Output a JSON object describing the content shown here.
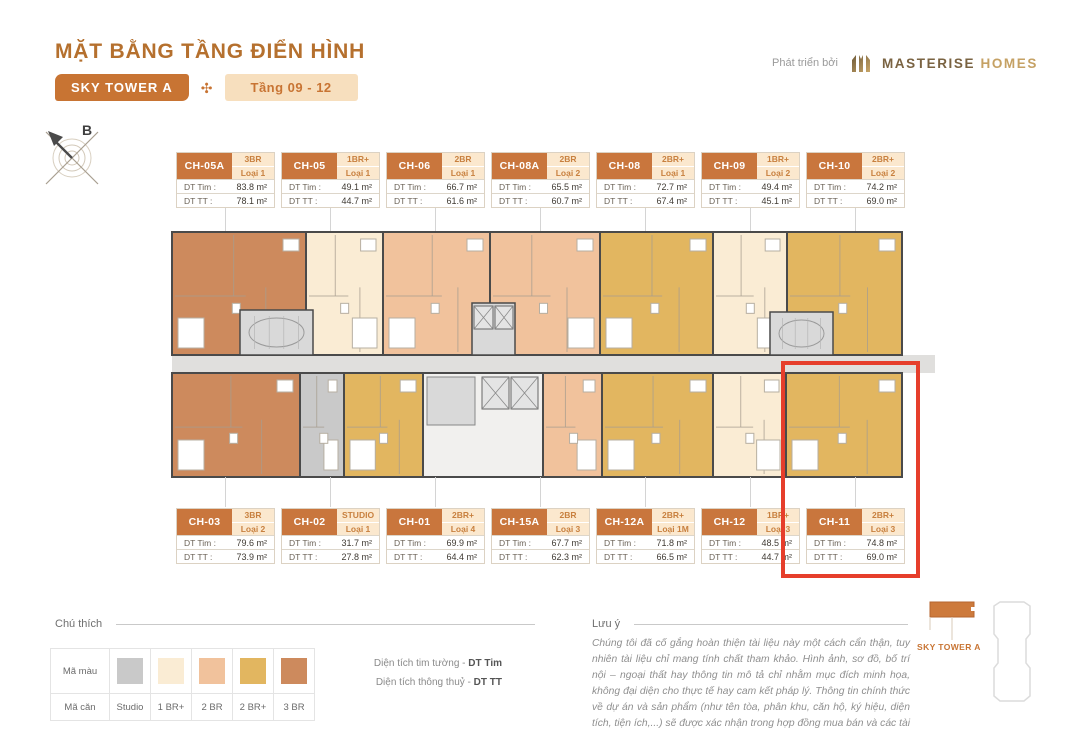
{
  "header": {
    "title": "MẶT BẰNG TẦNG ĐIỂN HÌNH",
    "tower_badge": "SKY TOWER A",
    "ornament_icon": "✣",
    "floor_badge": "Tầng 09 - 12",
    "developer_label": "Phát triển bởi",
    "developer_name_1": "MASTERISE",
    "developer_name_2": "HOMES"
  },
  "compass": {
    "label": "B"
  },
  "labels": {
    "dt_tim": "DT Tim :",
    "dt_tt": "DT TT :"
  },
  "colors": {
    "accent": "#c87433",
    "wall": "#4a4a4a",
    "corridor": "#e0dfdd",
    "core": "#d9d9d9",
    "highlight": "#e63e2b",
    "studio": "#c9c9c9",
    "br1p": "#faecd4",
    "br2": "#f1c29c",
    "br2p": "#e2b660",
    "br3": "#cd8a5d"
  },
  "plan": {
    "top_band": {
      "y": 232,
      "h": 123
    },
    "bottom_band": {
      "y": 373,
      "h": 104
    },
    "corridor": {
      "x": 172,
      "y": 355,
      "w": 763,
      "h": 18
    }
  },
  "units": {
    "top": [
      {
        "name": "CH-05A",
        "type": "3BR",
        "loai": "Loại 1",
        "tim": "83.8 m²",
        "tt": "78.1 m²",
        "color": "br3",
        "px": 172,
        "pw": 134,
        "highlighted": false
      },
      {
        "name": "CH-05",
        "type": "1BR+",
        "loai": "Loại 1",
        "tim": "49.1 m²",
        "tt": "44.7 m²",
        "color": "br1p",
        "px": 306,
        "pw": 77,
        "highlighted": false
      },
      {
        "name": "CH-06",
        "type": "2BR",
        "loai": "Loại 1",
        "tim": "66.7 m²",
        "tt": "61.6 m²",
        "color": "br2",
        "px": 383,
        "pw": 107,
        "highlighted": false
      },
      {
        "name": "CH-08A",
        "type": "2BR",
        "loai": "Loại 2",
        "tim": "65.5 m²",
        "tt": "60.7 m²",
        "color": "br2",
        "px": 490,
        "pw": 110,
        "highlighted": false
      },
      {
        "name": "CH-08",
        "type": "2BR+",
        "loai": "Loại 1",
        "tim": "72.7 m²",
        "tt": "67.4 m²",
        "color": "br2p",
        "px": 600,
        "pw": 113,
        "highlighted": false
      },
      {
        "name": "CH-09",
        "type": "1BR+",
        "loai": "Loại 2",
        "tim": "49.4 m²",
        "tt": "45.1 m²",
        "color": "br1p",
        "px": 713,
        "pw": 74,
        "highlighted": false
      },
      {
        "name": "CH-10",
        "type": "2BR+",
        "loai": "Loại 2",
        "tim": "74.2 m²",
        "tt": "69.0 m²",
        "color": "br2p",
        "px": 787,
        "pw": 115,
        "highlighted": false
      }
    ],
    "bottom": [
      {
        "name": "CH-03",
        "type": "3BR",
        "loai": "Loại 2",
        "tim": "79.6 m²",
        "tt": "73.9 m²",
        "color": "br3",
        "px": 172,
        "pw": 128,
        "highlighted": false
      },
      {
        "name": "CH-02",
        "type": "STUDIO",
        "loai": "Loại 1",
        "tim": "31.7 m²",
        "tt": "27.8 m²",
        "color": "studio",
        "px": 300,
        "pw": 44,
        "highlighted": false
      },
      {
        "name": "CH-01",
        "type": "2BR+",
        "loai": "Loại 4",
        "tim": "69.9 m²",
        "tt": "64.4 m²",
        "color": "br2p",
        "px": 344,
        "pw": 79,
        "highlighted": false
      },
      {
        "name": "CH-15A",
        "type": "2BR",
        "loai": "Loại 3",
        "tim": "67.7 m²",
        "tt": "62.3 m²",
        "color": "br2",
        "px": 543,
        "pw": 59,
        "highlighted": false
      },
      {
        "name": "CH-12A",
        "type": "2BR+",
        "loai": "Loại 1M",
        "tim": "71.8 m²",
        "tt": "66.5 m²",
        "color": "br2p",
        "px": 602,
        "pw": 111,
        "highlighted": false
      },
      {
        "name": "CH-12",
        "type": "1BR+",
        "loai": "Loại 3",
        "tim": "48.5 m²",
        "tt": "44.7 m²",
        "color": "br1p",
        "px": 713,
        "pw": 73,
        "highlighted": false
      },
      {
        "name": "CH-11",
        "type": "2BR+",
        "loai": "Loại 3",
        "tim": "74.8 m²",
        "tt": "69.0 m²",
        "color": "br2p",
        "px": 786,
        "pw": 116,
        "highlighted": true
      }
    ]
  },
  "legend": {
    "title": "Chú thích",
    "row1_label": "Mã màu",
    "row2_label": "Mã căn",
    "items": [
      {
        "label": "Studio",
        "color": "#c9c9c9"
      },
      {
        "label": "1 BR+",
        "color": "#faecd4"
      },
      {
        "label": "2 BR",
        "color": "#f1c29c"
      },
      {
        "label": "2 BR+",
        "color": "#e2b660"
      },
      {
        "label": "3 BR",
        "color": "#cd8a5d"
      }
    ]
  },
  "notes": {
    "line1_text": "Diện tích tim tường - ",
    "line1_bold": "DT Tim",
    "line2_text": "Diện tích thông thuỷ - ",
    "line2_bold": "DT TT"
  },
  "disclaimer": {
    "title": "Lưu ý",
    "text": "Chúng tôi đã cố gắng hoàn thiện tài liệu này một cách cẩn thận, tuy nhiên tài liệu chỉ mang tính chất tham khảo. Hình ảnh, sơ đồ, bố trí nội – ngoại thất hay thông tin mô tả chỉ nhằm mục đích minh họa, không đại diện cho thực tế hay cam kết pháp lý. Thông tin chính thức về dự án và sản phẩm (như tên tòa, phân khu, căn hộ, ký hiệu, diện tích, tiện ích,...) sẽ được xác nhận trong hợp đồng mua bán và các tài liệu ký với khách hàng."
  },
  "minimap": {
    "label": "SKY TOWER A"
  }
}
